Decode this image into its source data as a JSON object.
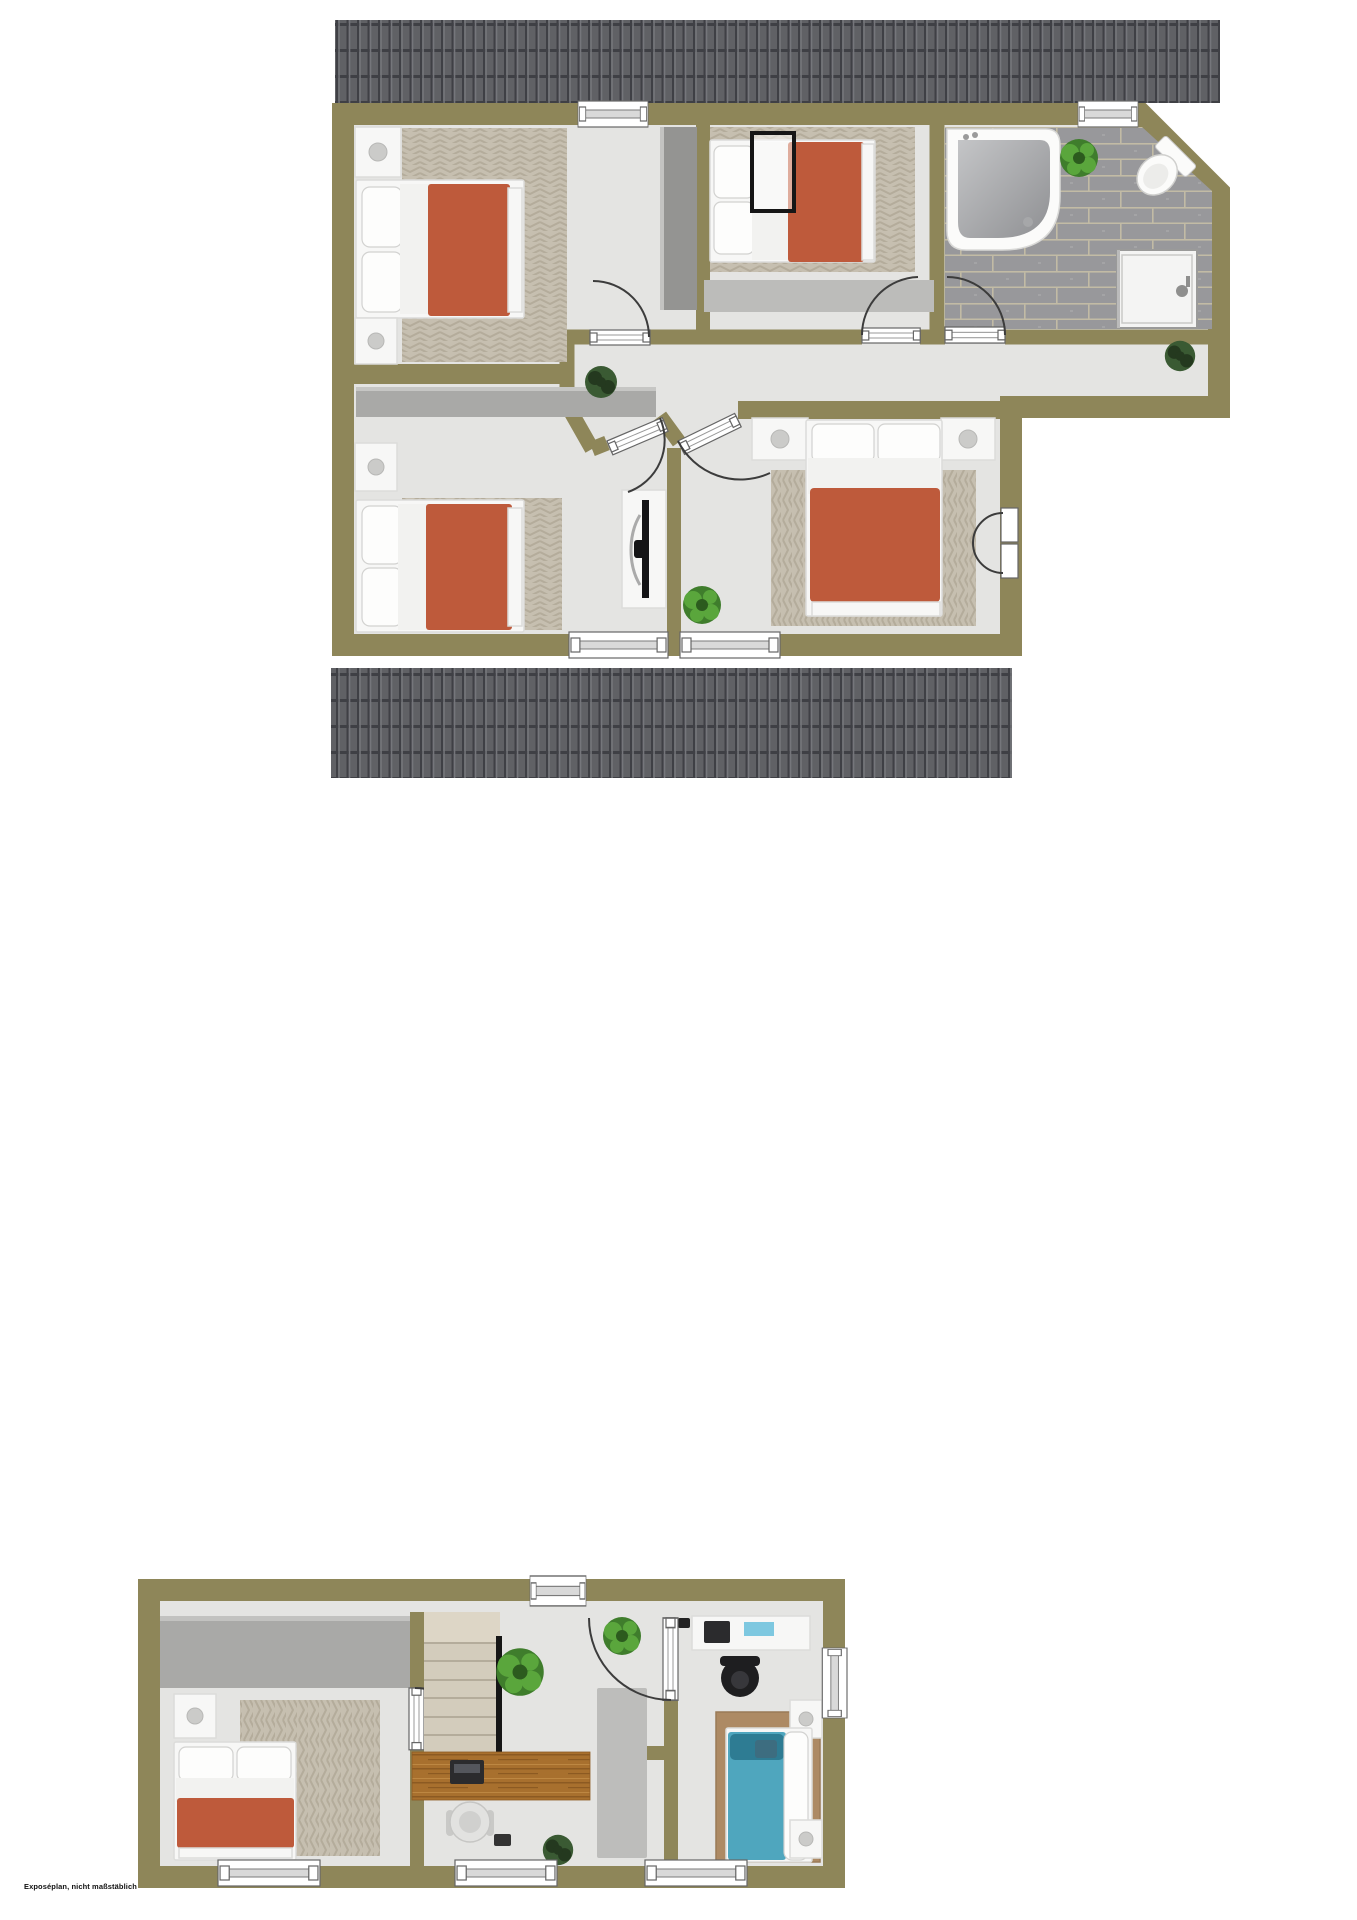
{
  "caption": "Exposéplan, nicht maßstäblich",
  "colors": {
    "wall": "#8E8659",
    "floor": "#E4E4E2",
    "roof-base": "#606165",
    "roof-dark": "#3F4045",
    "roof-light": "#75767B",
    "rug-base": "#C6BFB0",
    "rug-line": "#B4AC9B",
    "tile-base": "#98989B",
    "tile-grout": "#C2BBA5",
    "red": "#BE5A3B",
    "teal": "#4FA6BE",
    "teal-dark": "#2E7C93",
    "wood-base": "#A8702E",
    "wood-dark": "#8C5A22",
    "wood-light": "#BD8742",
    "runner": "#BDBDBB",
    "wardrobe": "#A9A9A7",
    "wardrobe-dark": "#949492",
    "stairs": "#D3CCBC",
    "stair-line": "#B4AC9B",
    "rail": "#161616",
    "plant-b1": "#5AA63C",
    "plant-b2": "#3F7D2C",
    "plant-b3": "#2C5B1E",
    "plant-d1": "#3A5A33",
    "plant-d2": "#24391F",
    "furn-white": "#F7F7F6",
    "furn-stroke": "#DCDCDA",
    "glyph-stroke": "#666666",
    "arc": "#3C3C3C",
    "tv": "#141416",
    "chair-dark": "#1E1E20",
    "water1": "#C4C5C7",
    "water2": "#8F9093",
    "bath-white": "#FBFBFA"
  },
  "floors": [
    {
      "id": "upper-floor",
      "rooms": [
        "bedroom-top-left",
        "bedroom-middle",
        "bathroom",
        "bedroom-bottom-left",
        "bedroom-master",
        "hallway"
      ]
    },
    {
      "id": "ground-floor",
      "rooms": [
        "bedroom-left",
        "stair-hallway",
        "bedroom-right"
      ]
    }
  ]
}
